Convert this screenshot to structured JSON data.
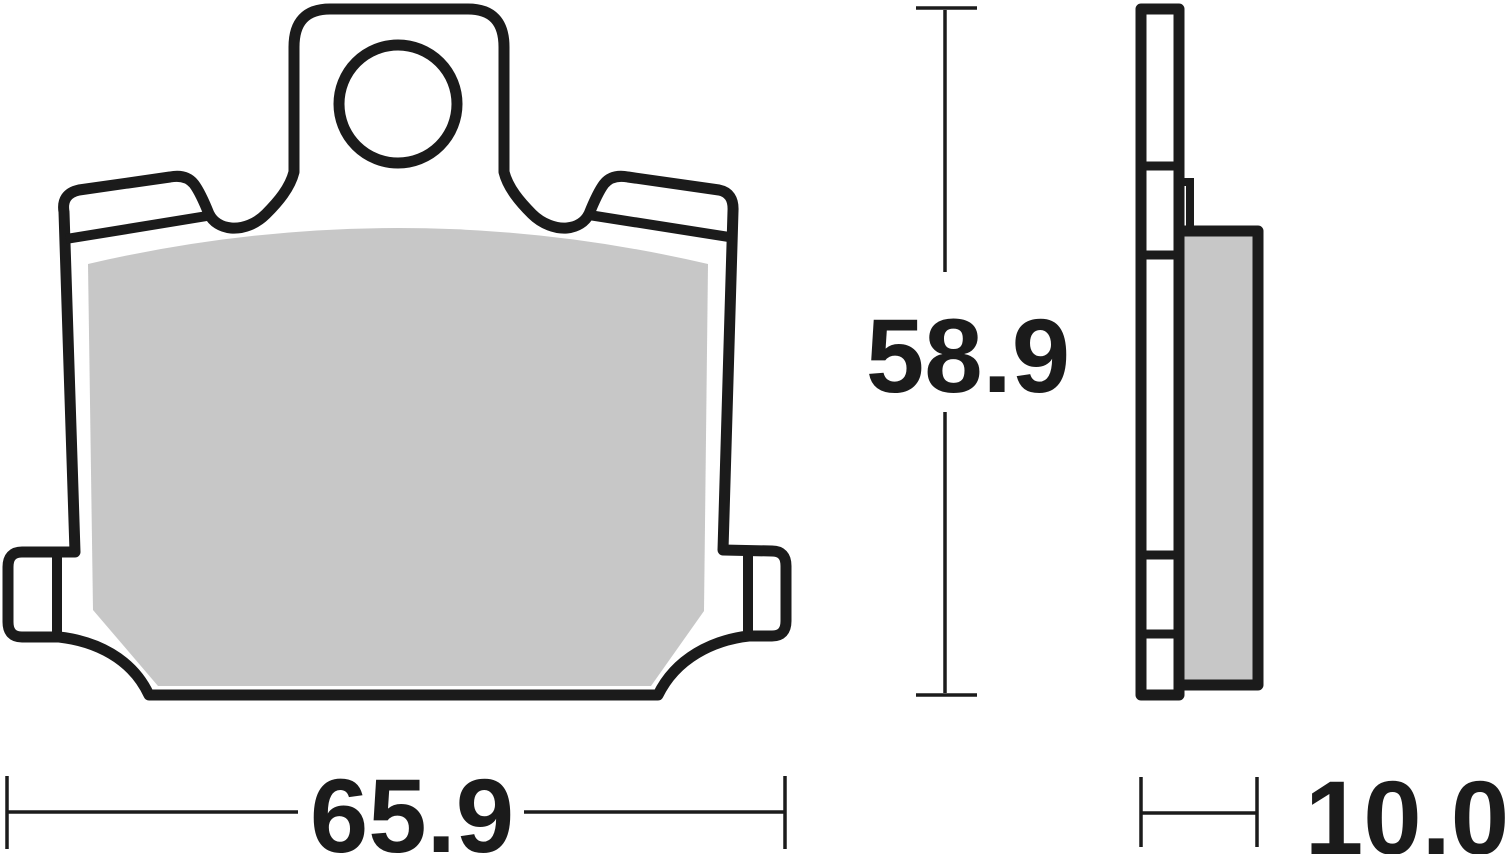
{
  "drawing": {
    "title": "brake-pad-technical-drawing",
    "views": {
      "front": {
        "label": "front-view",
        "features": [
          "backing-plate",
          "friction-material",
          "top-mounting-tab",
          "mounting-hole",
          "left-wing",
          "right-wing",
          "left-ear-lug",
          "right-ear-lug"
        ]
      },
      "side": {
        "label": "side-view",
        "features": [
          "backing-plate-profile",
          "friction-material-block",
          "step-lip"
        ]
      }
    },
    "dimensions": {
      "width": {
        "value": "65.9",
        "axis": "horizontal",
        "applies_to": "front-view overall width"
      },
      "height": {
        "value": "58.9",
        "axis": "vertical",
        "applies_to": "front-view overall height"
      },
      "thickness": {
        "value": "10.0",
        "axis": "horizontal",
        "applies_to": "side-view overall thickness"
      }
    },
    "colors": {
      "outline": "#1b1b1b",
      "friction_material": "#c7c7c7",
      "background": "#ffffff"
    }
  }
}
